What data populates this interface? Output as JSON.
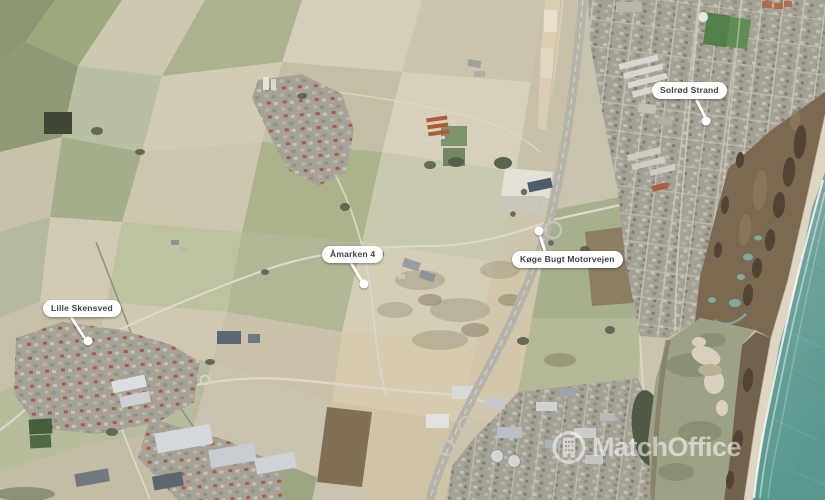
{
  "map": {
    "type": "satellite-aerial-photo",
    "markers": [
      {
        "id": "solrod-strand",
        "label": "Solrød Strand"
      },
      {
        "id": "amarken-4",
        "label": "Åmarken 4"
      },
      {
        "id": "koge-bugt-motorvejen",
        "label": "Køge Bugt Motorvejen"
      },
      {
        "id": "lille-skensved",
        "label": "Lille Skensved"
      }
    ],
    "watermark": {
      "text": "MatchOffice",
      "icon": "building-in-circle-icon",
      "color": "#ffffff"
    },
    "colors": {
      "sea": "#5d9a91",
      "beach": "#ded5c1",
      "marsh": "#77644b",
      "lagoon": "#9aa083",
      "urban": "#a29f94",
      "field_light": "#d7d1ba",
      "field_green": "#9ba679",
      "motorway": "#b3b0a6",
      "label_bg": "#ffffff",
      "label_text": "#3e4347"
    }
  }
}
